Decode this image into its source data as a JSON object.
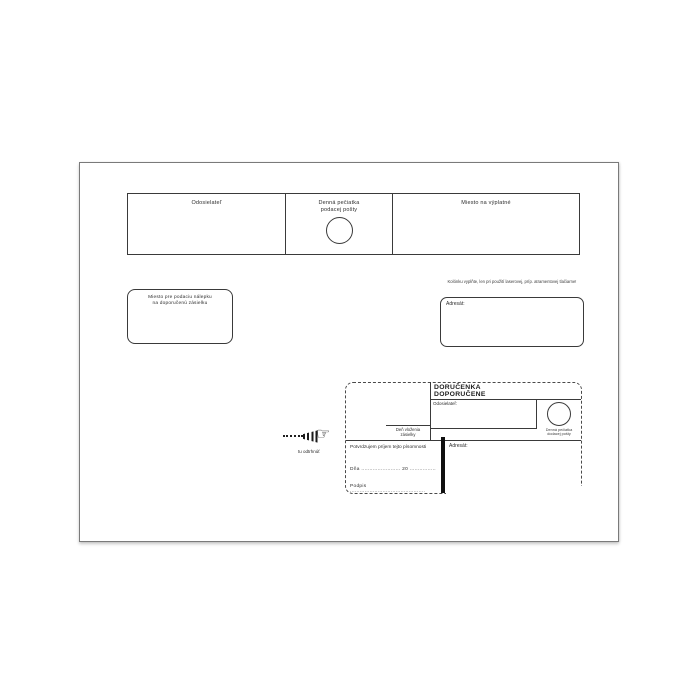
{
  "colors": {
    "ink": "#2e2e2e",
    "line": "#3a3a3a",
    "background": "#ffffff"
  },
  "top_strip": {
    "sender_label": "Odosielateľ",
    "stamp_label": [
      "Denná pečiatka",
      "podacej pošty"
    ],
    "postage_label": "Miesto na výplatné"
  },
  "registration_box": {
    "line1": "Miesto pre podaciu nálepku",
    "line2": "na doporučenú zásielku"
  },
  "addressee": {
    "note": "Kolónku vyplňte, len pri použití laserovej, príp. atramentovej tlačiarne!",
    "label": "Adresát:"
  },
  "tear_off": {
    "hand_icon": "☞",
    "label": "tu odtrhnúť"
  },
  "delivery_slip": {
    "title": [
      "DORUČENKA",
      "DOPORUČENE"
    ],
    "sender_label": "Odosielateľ:",
    "day_label": [
      "Deň vloženia",
      "zásielky"
    ],
    "stamp_caption": [
      "Denná pečiatka",
      "dodacej pošty"
    ],
    "confirm_text": "Potvrdzujem príjem tejto písomnosti",
    "date_line": "Dňa ........................  20 ................",
    "signature_line": "Podpis ..............................................",
    "addressee_label": "Adresát:"
  }
}
